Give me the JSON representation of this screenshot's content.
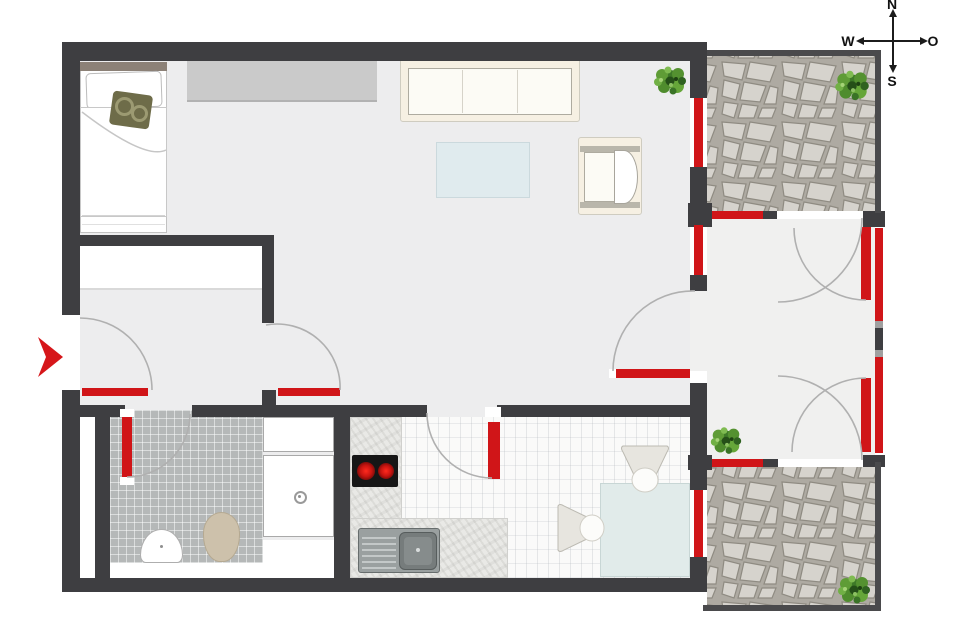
{
  "title": "apartment-floor-plan",
  "compass": {
    "north": "N",
    "south": "S",
    "west": "W",
    "east": "O"
  },
  "colors": {
    "wall": "#3e3e41",
    "opening_marker_red": "#d01518",
    "door_swing_arc": "#b0b0b0",
    "floor_main": "#ededee",
    "floor_loggia": "#f0f0ef",
    "bath_tile": "#b5b8b8",
    "terrace_stone": "#d6d3cd",
    "terrace_joint": "#aeaaa2",
    "sofa_cream": "#f6f0e3",
    "table_blue": "#e0ebee",
    "cooktop_black": "#161616",
    "burner_red": "#c81410",
    "plant_green": "#4c8a2f",
    "toilet_beige": "#cdc1ab",
    "entry_arrow_red": "#d6161a"
  },
  "markers": {
    "red_bars_count": 14,
    "door_swings_count": 9,
    "items": [
      "entry-door-leaf",
      "hall-door-leaf",
      "bathroom-door-leaf",
      "kitchen-door-leaf",
      "living-loggia-door-leaf",
      "living-terrace1-window",
      "living-loggia-window",
      "loggia-terrace1-window",
      "loggia-terrace2-window",
      "dining-terrace2-window",
      "loggia-east-door-top-leaf",
      "loggia-east-door-bottom-leaf",
      "loggia-east-glazing-top",
      "loggia-east-glazing-bottom"
    ]
  },
  "furniture": [
    "bed",
    "headboard",
    "pillow",
    "cushion",
    "sideboard",
    "sofa",
    "coffee-table",
    "armchair",
    "dining-table",
    "dining-chair",
    "dining-chair",
    "kitchen-counter",
    "cooktop",
    "kitchen-sink",
    "bathroom-sink",
    "toilet",
    "shower",
    "bathroom-cabinet"
  ],
  "plants_count": 4,
  "terraces_count": 2
}
